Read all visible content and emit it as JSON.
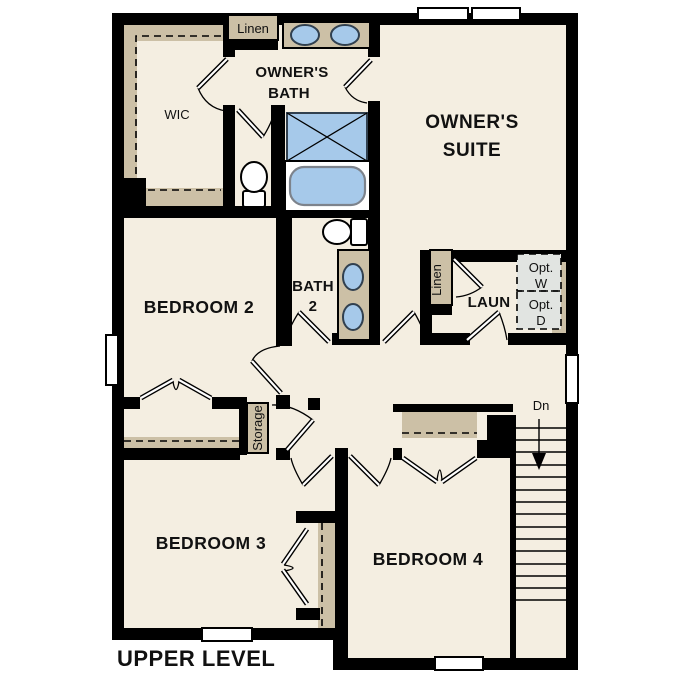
{
  "title": "UPPER LEVEL",
  "colors": {
    "wall": "#000000",
    "floor": "#f4eee1",
    "closet": "#ccc0a6",
    "fixture": "#a6c9ea",
    "optional": "#e1e4e1"
  },
  "rooms": {
    "wic": {
      "label": "WIC"
    },
    "linen_top": {
      "label": "Linen"
    },
    "owners_bath": {
      "lines": [
        "OWNER'S",
        "BATH"
      ]
    },
    "owners_suite": {
      "lines": [
        "OWNER'S",
        "SUITE"
      ]
    },
    "bedroom2": {
      "label": "BEDROOM 2"
    },
    "bath2": {
      "lines": [
        "BATH",
        "2"
      ]
    },
    "linen_laundry": {
      "label": "Linen"
    },
    "laundry": {
      "label": "LAUN"
    },
    "opt_washer": {
      "lines": [
        "Opt.",
        "W"
      ]
    },
    "opt_dryer": {
      "lines": [
        "Opt.",
        "D"
      ]
    },
    "storage": {
      "label": "Storage"
    },
    "stairs": {
      "down_label": "Dn"
    },
    "bedroom3": {
      "label": "BEDROOM 3"
    },
    "bedroom4": {
      "label": "BEDROOM 4"
    }
  }
}
